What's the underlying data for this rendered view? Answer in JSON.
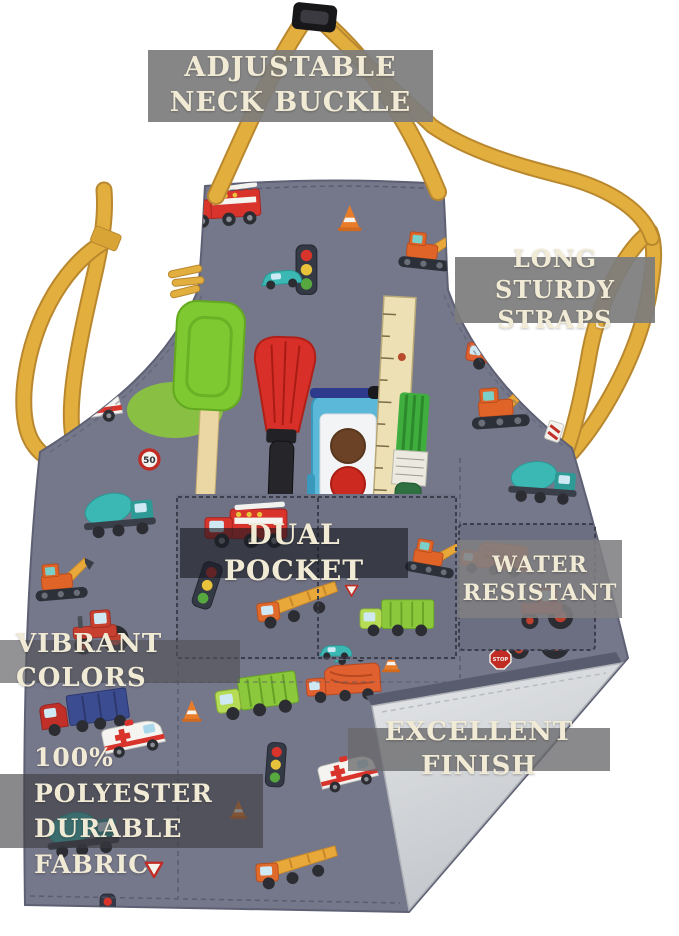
{
  "image_type": "product-photo",
  "subject": "kids apron with vehicle print fabric, yellow straps and art tools in pocket",
  "callouts": {
    "neck_buckle": "ADJUSTABLE NECK BUCKLE",
    "straps": "LONG STURDY STRAPS",
    "dual_pocket": "DUAL POCKET",
    "water_resistant": "WATER RESISTANT",
    "vibrant_colors": "VIBRANT COLORS",
    "excellent_finish": "EXCELLENT FINISH",
    "fabric": "100% POLYESTER DURABLE FABRIC"
  },
  "sign_text": {
    "stop": "STOP",
    "speed_limit": "50"
  },
  "colors": {
    "background": "#ffffff",
    "fabric": "#75778a",
    "strap": "#e2ae3e",
    "label_text": "#f1ead5",
    "lining": "#d8dadc",
    "spatula": "#7ec832",
    "basting_brush": "#d83028",
    "paintbox": "#5bb8d8",
    "ruler": "#ece0b4",
    "paint_brush_handle": "#2e7040"
  }
}
